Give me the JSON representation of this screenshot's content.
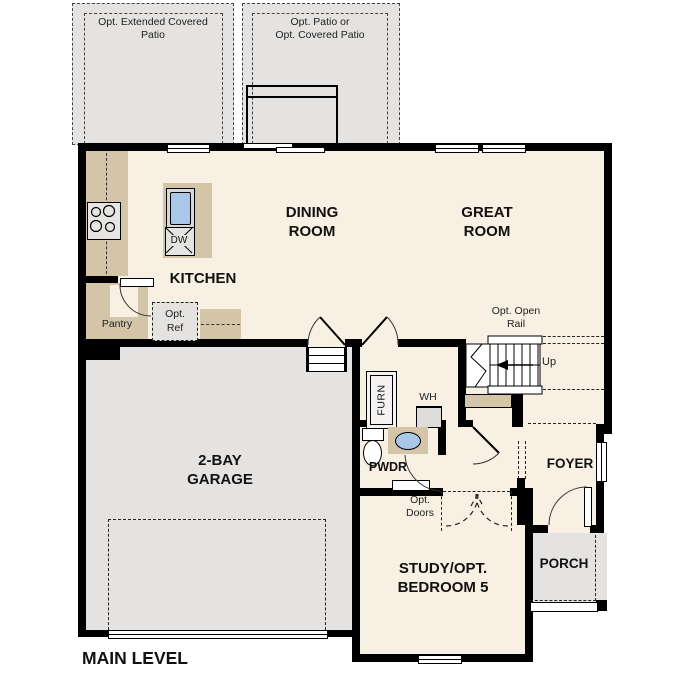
{
  "plan": {
    "title": "MAIN LEVEL",
    "rooms": {
      "kitchen": "KITCHEN",
      "dining": "DINING\nROOM",
      "great": "GREAT\nROOM",
      "garage": "2-BAY\nGARAGE",
      "study": "STUDY/OPT.\nBEDROOM 5",
      "foyer": "FOYER",
      "porch": "PORCH",
      "powder": "PWDR",
      "pantry": "Pantry"
    },
    "options": {
      "extended_patio": "Opt. Extended Covered\nPatio",
      "patio": "Opt. Patio or\nOpt. Covered Patio",
      "open_rail": "Opt. Open\nRail",
      "ref": "Opt.\nRef",
      "doors": "Opt.\nDoors"
    },
    "fixtures": {
      "dishwasher": "DW",
      "furnace": "FURN",
      "water_heater": "WH",
      "stairs_direction": "Up"
    },
    "colors": {
      "wall": "#000000",
      "interior_floor": "#f8f0e2",
      "exterior_concrete": "#e4e3e1",
      "counter": "#d4c5a9",
      "sink_fixture": "#a9c7e9"
    }
  }
}
